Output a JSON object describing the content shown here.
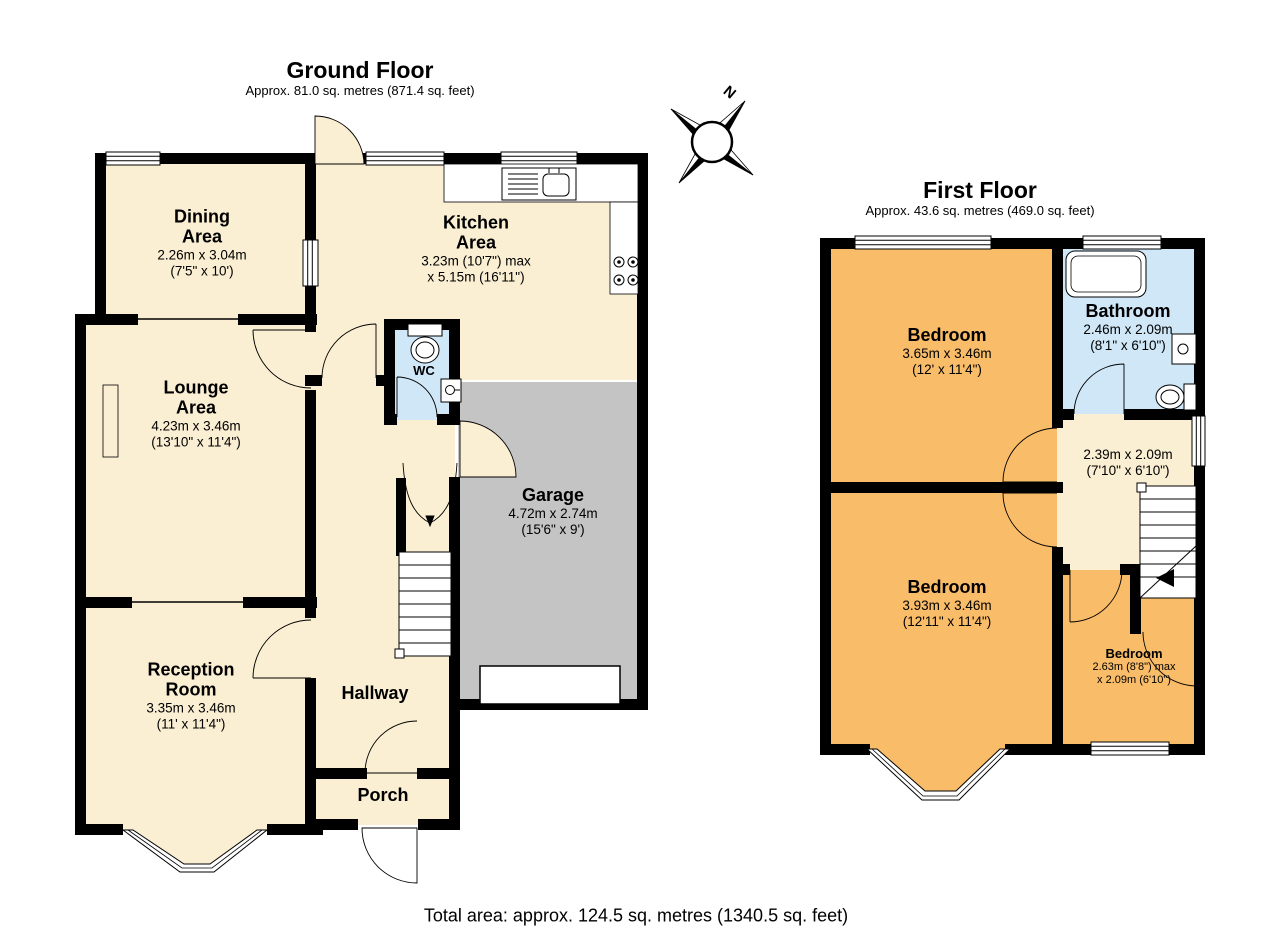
{
  "ground_floor": {
    "title": "Ground Floor",
    "subtitle": "Approx. 81.0 sq. metres (871.4 sq. feet)",
    "rooms": {
      "dining": {
        "name": "Dining\nArea",
        "metric": "2.26m x 3.04m",
        "imperial": "(7'5\" x 10')"
      },
      "kitchen": {
        "name": "Kitchen\nArea",
        "metric": "3.23m (10'7\") max",
        "imperial": "x 5.15m (16'11\")"
      },
      "lounge": {
        "name": "Lounge\nArea",
        "metric": "4.23m x 3.46m",
        "imperial": "(13'10\" x 11'4\")"
      },
      "wc": {
        "name": "WC"
      },
      "garage": {
        "name": "Garage",
        "metric": "4.72m x 2.74m",
        "imperial": "(15'6\" x 9')"
      },
      "reception": {
        "name": "Reception\nRoom",
        "metric": "3.35m x 3.46m",
        "imperial": "(11' x 11'4\")"
      },
      "hallway": {
        "name": "Hallway"
      },
      "porch": {
        "name": "Porch"
      }
    }
  },
  "first_floor": {
    "title": "First Floor",
    "subtitle": "Approx. 43.6 sq. metres (469.0 sq. feet)",
    "rooms": {
      "bedroom1": {
        "name": "Bedroom",
        "metric": "3.65m x 3.46m",
        "imperial": "(12' x 11'4\")"
      },
      "bathroom": {
        "name": "Bathroom",
        "metric": "2.46m x 2.09m",
        "imperial": "(8'1\" x 6'10\")"
      },
      "landing": {
        "metric": "2.39m x 2.09m",
        "imperial": "(7'10\" x 6'10\")"
      },
      "bedroom2": {
        "name": "Bedroom",
        "metric": "3.93m x 3.46m",
        "imperial": "(12'11\" x 11'4\")"
      },
      "bedroom3": {
        "name": "Bedroom",
        "metric": "2.63m (8'8\") max",
        "imperial": "x 2.09m (6'10\")"
      }
    }
  },
  "compass": {
    "north_label": "N"
  },
  "footer": {
    "total": "Total area: approx. 124.5 sq. metres (1340.5 sq. feet)"
  },
  "colors": {
    "room_cream": "#FAEED3",
    "room_orange": "#F9BC69",
    "room_blue": "#CFE7F7",
    "garage_grey": "#C4C4C4",
    "wall_black": "#000000"
  }
}
